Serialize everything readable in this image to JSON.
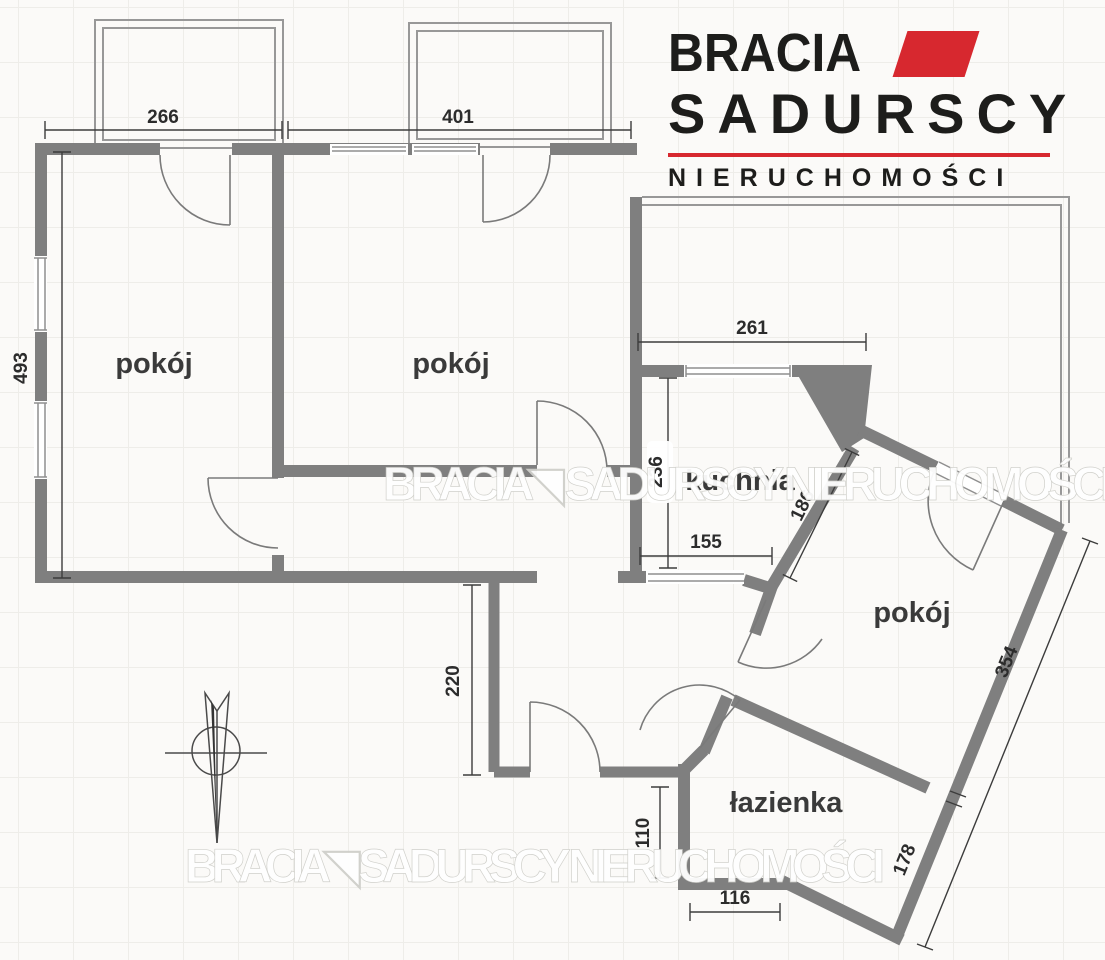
{
  "logo": {
    "brand_line1": "BRACIA",
    "brand_line2": "SADURSCY",
    "tagline": "NIERUCHOMOŚCI",
    "accent_red": "#d7282f",
    "mark_icon": "red-parallelogram"
  },
  "watermark": {
    "text": "BRACIA◥ SADURSCY NIERUCHOMOŚCI"
  },
  "plan": {
    "rooms": [
      {
        "id": "room-1",
        "label": "pokój"
      },
      {
        "id": "room-2",
        "label": "pokój"
      },
      {
        "id": "kitchen",
        "label": "kuchnia"
      },
      {
        "id": "room-3",
        "label": "pokój"
      },
      {
        "id": "bathroom",
        "label": "łazienka"
      }
    ],
    "dimensions_cm": {
      "room1_top": "266",
      "room2_top": "401",
      "left_side": "493",
      "kitchen_top": "261",
      "kitchen_left": "236",
      "kitchen_bottom": "155",
      "kitchen_diagonal": "186",
      "hall_left": "220",
      "bathroom_left": "110",
      "bathroom_bottom": "116",
      "bathroom_diagonal": "178",
      "room3_diagonal": "354"
    },
    "symbols": {
      "compass": "north-arrow"
    },
    "colors": {
      "wall_gray": "#7f7f7f",
      "accent_red": "#d7282f"
    }
  }
}
